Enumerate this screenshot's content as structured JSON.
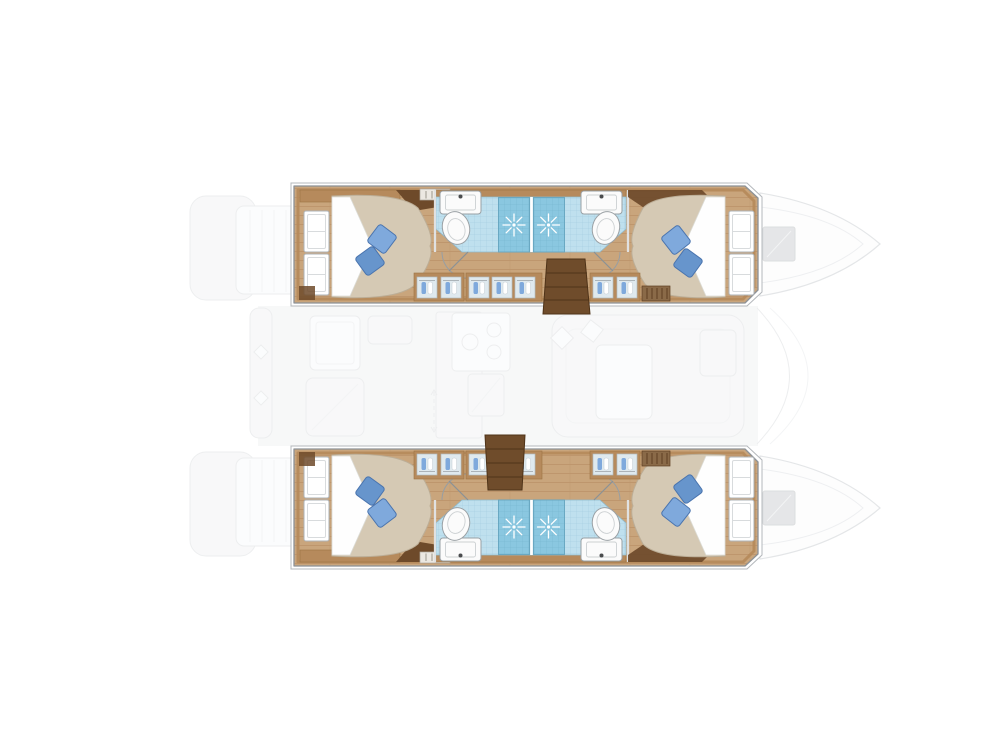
{
  "scene": {
    "type": "yacht-floorplan",
    "vessel": "catamaran",
    "orientation": "bows-right-sterns-left",
    "cabin_count": 4,
    "bathroom_count": 4,
    "shower_count": 4,
    "hulls": [
      {
        "id": "port-hull",
        "position": "top",
        "rooms": [
          {
            "name": "aft-double-cabin",
            "features": [
              "island-bed",
              "white-sheet-fold",
              "two-blue-pillows",
              "two-hull-windows"
            ]
          },
          {
            "name": "aft-bathroom",
            "features": [
              "sink",
              "toilet",
              "shower-with-starburst",
              "door-swing"
            ]
          },
          {
            "name": "forward-bathroom",
            "features": [
              "sink",
              "toilet",
              "shower-with-starburst",
              "door-swing"
            ]
          },
          {
            "name": "forward-double-cabin",
            "features": [
              "island-bed",
              "white-sheet-fold",
              "two-blue-pillows",
              "two-hull-windows"
            ]
          },
          {
            "name": "companionway-stairs",
            "features": [
              "four-wood-steps"
            ]
          },
          {
            "name": "inboard-wardrobes",
            "features": [
              "hanging-clothes-panels",
              "vent-grille"
            ]
          }
        ]
      },
      {
        "id": "starboard-hull",
        "position": "bottom",
        "rooms": [
          {
            "name": "aft-double-cabin",
            "features": [
              "island-bed",
              "white-sheet-fold",
              "two-blue-pillows",
              "two-hull-windows"
            ]
          },
          {
            "name": "aft-bathroom",
            "features": [
              "sink",
              "toilet",
              "shower-with-starburst",
              "door-swing"
            ]
          },
          {
            "name": "forward-bathroom",
            "features": [
              "sink",
              "toilet",
              "shower-with-starburst",
              "door-swing"
            ]
          },
          {
            "name": "forward-double-cabin",
            "features": [
              "island-bed",
              "white-sheet-fold",
              "two-blue-pillows",
              "two-hull-windows"
            ]
          },
          {
            "name": "companionway-stairs",
            "features": [
              "four-wood-steps"
            ]
          },
          {
            "name": "inboard-wardrobes",
            "features": [
              "hanging-clothes-panels",
              "vent-grille"
            ]
          }
        ]
      }
    ],
    "bridgedeck_faded": [
      "stern-swim-platforms",
      "aft-crossbeam-with-cleats",
      "cockpit-table-and-seating",
      "galley-counter-sink-stove-fridge",
      "salon-dinette-with-table",
      "windshield-curve",
      "bow-outlines",
      "foredeck-hatches"
    ]
  },
  "palette": {
    "background": "#ffffff",
    "hull_outline": "#8d9297",
    "deck_outline": "#b4b8bc",
    "wood_floor": "#c9a57c",
    "wood_plank_line": "#bb9268",
    "wood_trim": "#b68a5c",
    "wood_trim_dark": "#9c7344",
    "wood_dark": "#6e4a2a",
    "stairs": "#6f4c2b",
    "stairs_line": "#4f3318",
    "bed": "#d5c9b4",
    "bed_edge": "#bcae97",
    "sheet": "#fefefe",
    "pillow_light": "#7fa9dc",
    "pillow_dark": "#6795cc",
    "pillow_edge": "#4a74ae",
    "tile": "#bfe0ee",
    "tile_line": "#9fcbdd",
    "shower": "#8ac7e0",
    "shower_line": "#74b2cc",
    "fixture": "#fbfbfb",
    "fixture_edge": "#9aa0a4",
    "wardrobe_panel": "#dfe9ee",
    "faded_fill": "#f4f5f6",
    "faded_stroke": "#e2e4e6",
    "hatch_gray": "#d5d7d9"
  }
}
